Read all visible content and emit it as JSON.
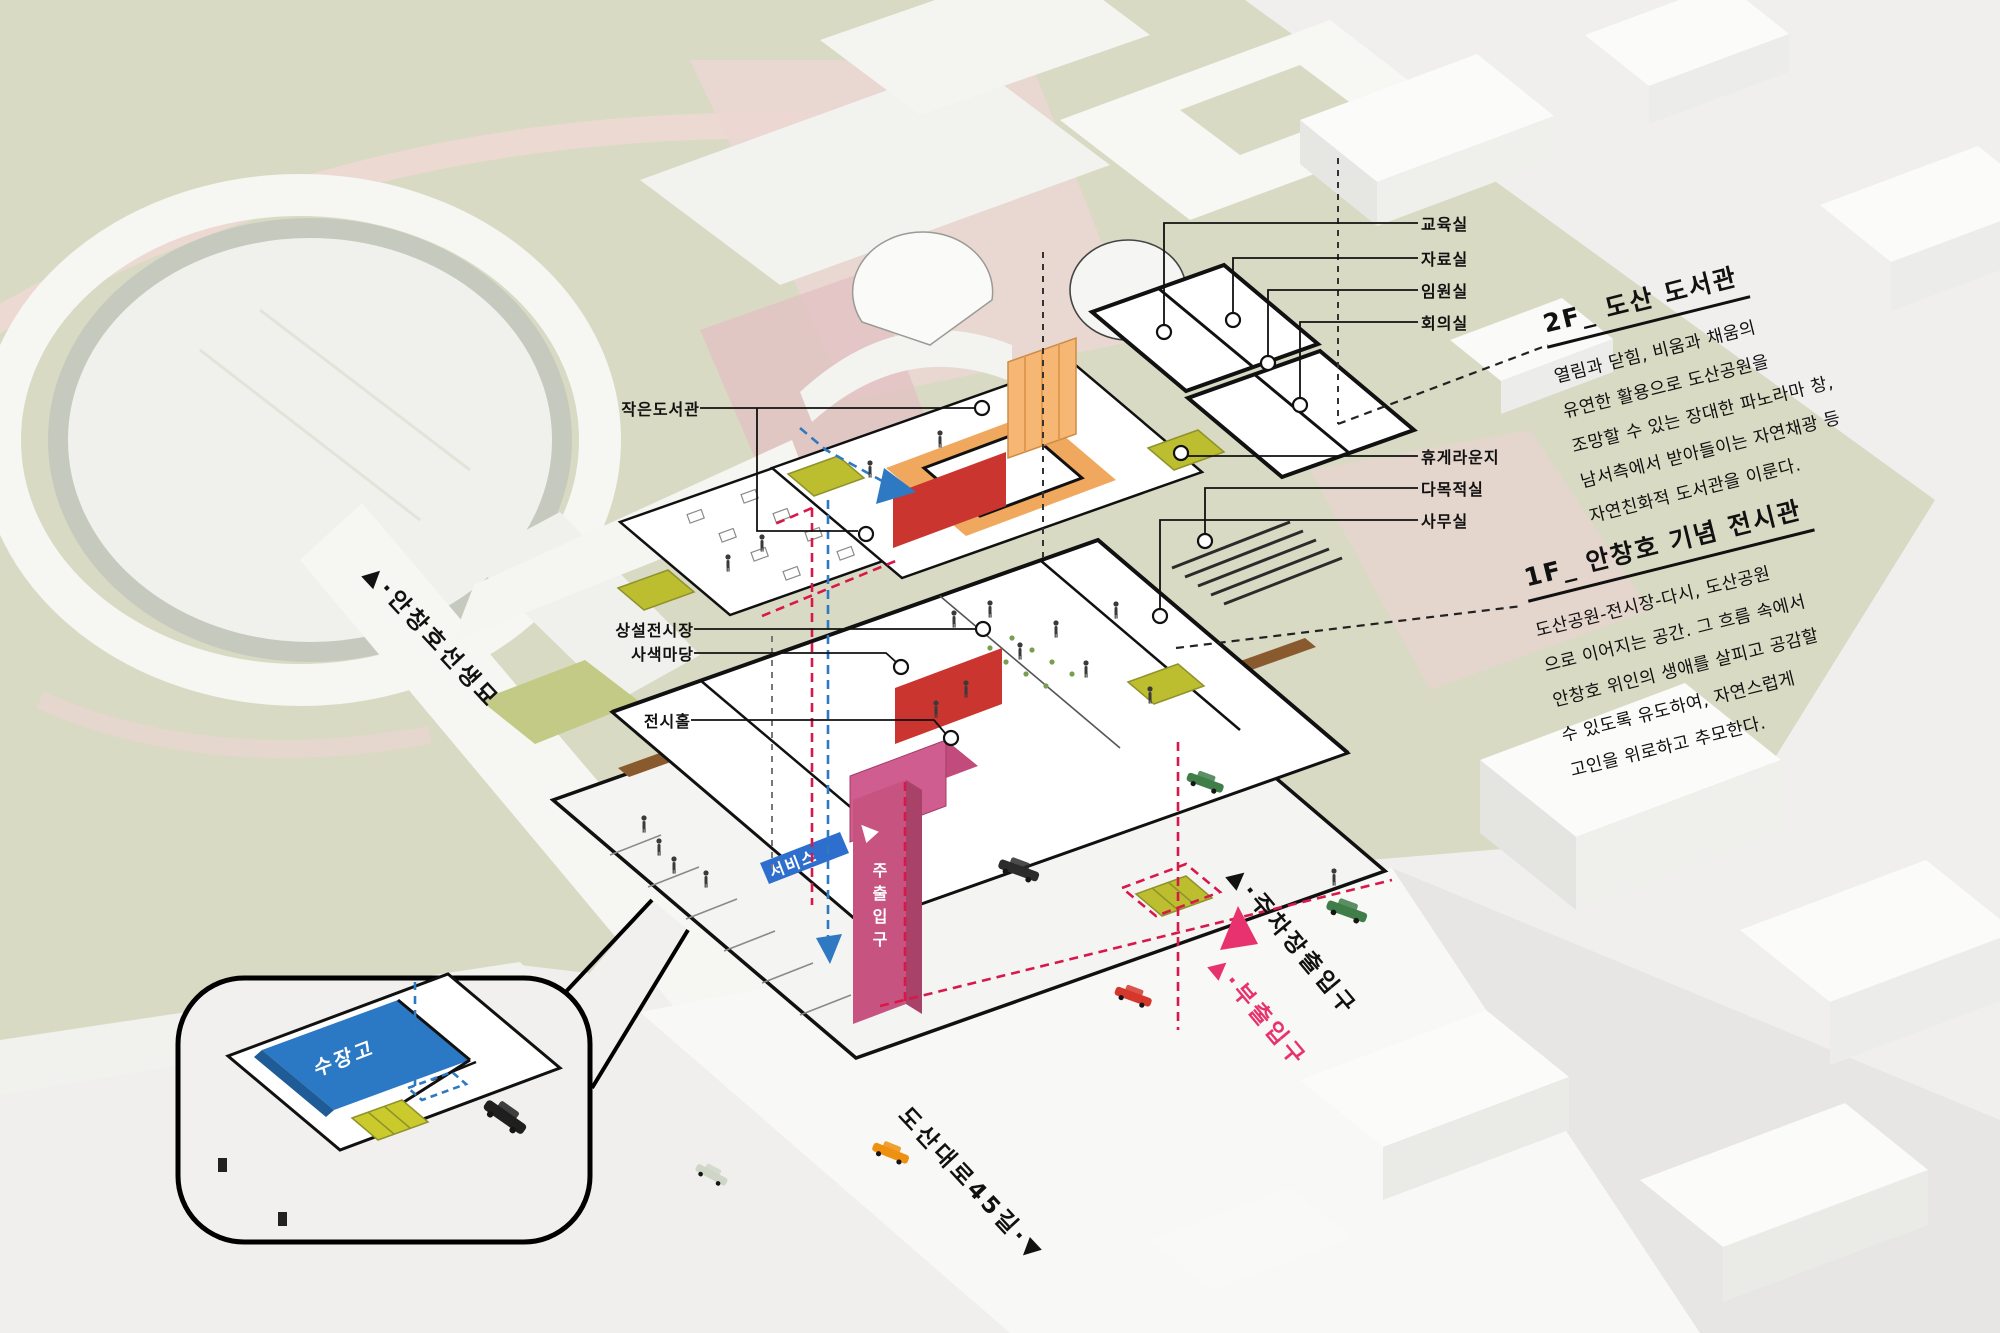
{
  "scene": {
    "left_labels": [
      "작은도서관",
      "상설전시장",
      "사색마당",
      "전시홀"
    ],
    "right_labels": [
      "교육실",
      "자료실",
      "임원실",
      "회의실",
      "휴게라운지",
      "다목적실",
      "사무실"
    ],
    "text_blocks": [
      {
        "title": "2F_ 도산 도서관",
        "lines": [
          "열림과 닫힘, 비움과 채움의",
          "유연한 활용으로 도산공원을",
          "조망할 수 있는 장대한 파노라마 창,",
          "남서측에서 받아들이는 자연채광 등",
          "자연친화적 도서관을 이룬다."
        ]
      },
      {
        "title": "1F_ 안창호 기념 전시관",
        "lines": [
          "도산공원-전시장-다시, 도산공원",
          "으로 이어지는 공간. 그 흐름 속에서",
          "안창호 위인의 생애를 살피고 공감할",
          "수 있도록 유도하여, 자연스럽게",
          "고인을 위로하고 추모한다."
        ]
      }
    ],
    "site_labels": {
      "grave_road": "▲·안창호선생묘",
      "parking_entrance": "▲·주차장출입구",
      "sub_entrance": "▲·부출입구",
      "street": "도산대로45길·▼"
    },
    "signs": {
      "service": "서비스",
      "main_entrance": "주출입구",
      "main_entrance_arrow": "▲",
      "storage": "수장고"
    },
    "colors": {
      "park_green": "#d8dac3",
      "path_pink": "#ecd9d2",
      "accent_red": "#cb352f",
      "accent_orange": "#f2a65a",
      "accent_magenta": "#c75380",
      "accent_blue": "#2e79c1",
      "accent_olive": "#bcbe2f",
      "wood_brown": "#8a5a2f",
      "sub_entrance_pink": "#e8326f",
      "storage_blue": "#2b78c4"
    }
  }
}
